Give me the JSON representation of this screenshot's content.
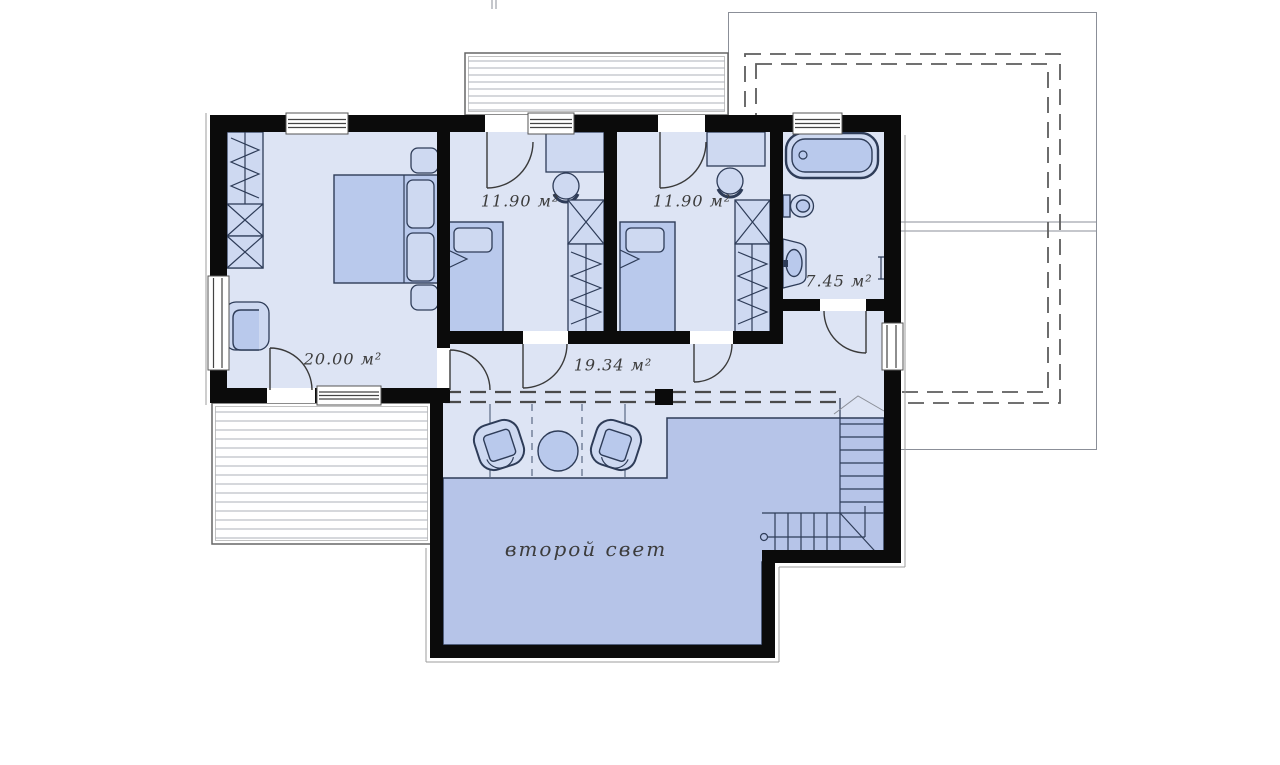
{
  "rooms": [
    {
      "id": "master-bedroom",
      "area_label": "20.00 м²"
    },
    {
      "id": "bedroom-2",
      "area_label": "11.90 м²"
    },
    {
      "id": "bedroom-3",
      "area_label": "11.90 м²"
    },
    {
      "id": "bathroom",
      "area_label": "7.45 м²"
    },
    {
      "id": "hall",
      "area_label": "19.34 м²"
    }
  ],
  "void_label": "второй свет",
  "colors": {
    "wall": "#0b0b0b",
    "room_light": "#dde4f4",
    "room_dark": "#b6c4e8",
    "furniture": "#b9c9ec",
    "furniture_light": "#ced9f1",
    "outline": "#2e3c58",
    "dashed": "#4a4a4a",
    "label_text": "#3c3c3c",
    "hatch": "#aeb2b8"
  }
}
